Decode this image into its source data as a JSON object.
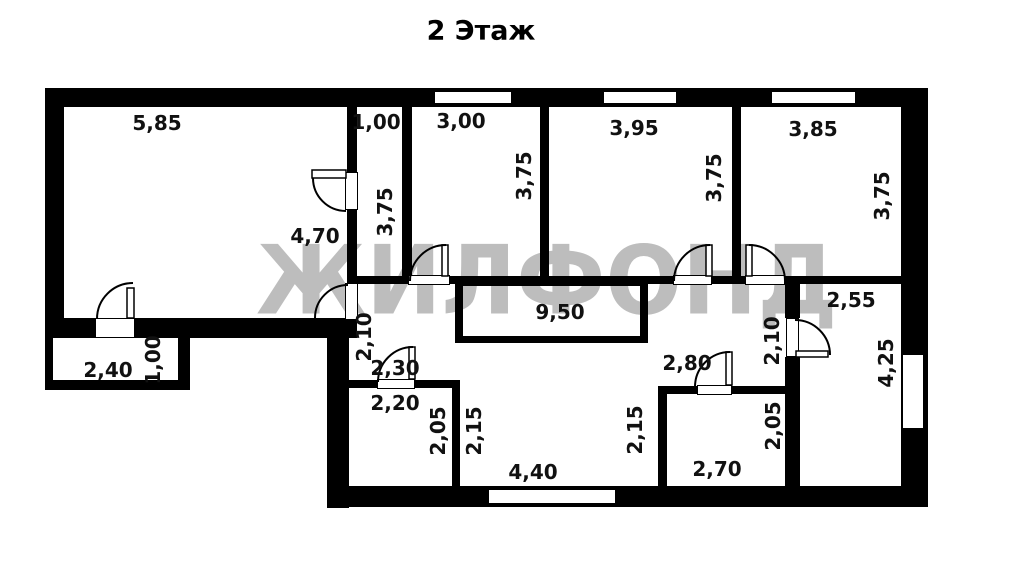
{
  "title": "2 Этаж",
  "watermark": "ЖИЛФОНД",
  "colors": {
    "wall": "#000000",
    "background": "#ffffff",
    "watermark": "#bdbdbd",
    "dimension_text": "#111111"
  },
  "dimensions": [
    {
      "id": "living-width",
      "text": "5,85",
      "orientation": "horizontal"
    },
    {
      "id": "closet-width",
      "text": "1,00",
      "orientation": "horizontal"
    },
    {
      "id": "room1-width",
      "text": "3,00",
      "orientation": "horizontal"
    },
    {
      "id": "room2-width",
      "text": "3,95",
      "orientation": "horizontal"
    },
    {
      "id": "room3-width",
      "text": "3,85",
      "orientation": "horizontal"
    },
    {
      "id": "living-depth",
      "text": "4,70",
      "orientation": "horizontal"
    },
    {
      "id": "stairwell-size",
      "text": "9,50",
      "orientation": "horizontal"
    },
    {
      "id": "bedroom-width",
      "text": "2,55",
      "orientation": "horizontal"
    },
    {
      "id": "balcony-width",
      "text": "2,40",
      "orientation": "horizontal"
    },
    {
      "id": "nook-width",
      "text": "2,30",
      "orientation": "horizontal"
    },
    {
      "id": "bath-width",
      "text": "2,20",
      "orientation": "horizontal"
    },
    {
      "id": "hall-right-width",
      "text": "2,80",
      "orientation": "horizontal"
    },
    {
      "id": "wc-width",
      "text": "2,70",
      "orientation": "horizontal"
    },
    {
      "id": "hall-width",
      "text": "4,40",
      "orientation": "horizontal"
    },
    {
      "id": "closet-depth",
      "text": "3,75",
      "orientation": "vertical"
    },
    {
      "id": "room1-depth",
      "text": "3,75",
      "orientation": "vertical"
    },
    {
      "id": "room2-depth",
      "text": "3,75",
      "orientation": "vertical"
    },
    {
      "id": "room3-depth",
      "text": "3,75",
      "orientation": "vertical"
    },
    {
      "id": "balcony-depth",
      "text": "1,00",
      "orientation": "vertical"
    },
    {
      "id": "nook-depth",
      "text": "2,10",
      "orientation": "vertical"
    },
    {
      "id": "corridor-right-depth",
      "text": "2,10",
      "orientation": "vertical"
    },
    {
      "id": "bedroom-depth",
      "text": "4,25",
      "orientation": "vertical"
    },
    {
      "id": "bath-depth",
      "text": "2,05",
      "orientation": "vertical"
    },
    {
      "id": "hall-left-depth",
      "text": "2,15",
      "orientation": "vertical"
    },
    {
      "id": "hall-mid-depth",
      "text": "2,15",
      "orientation": "vertical"
    },
    {
      "id": "wc-depth",
      "text": "2,05",
      "orientation": "vertical"
    }
  ]
}
